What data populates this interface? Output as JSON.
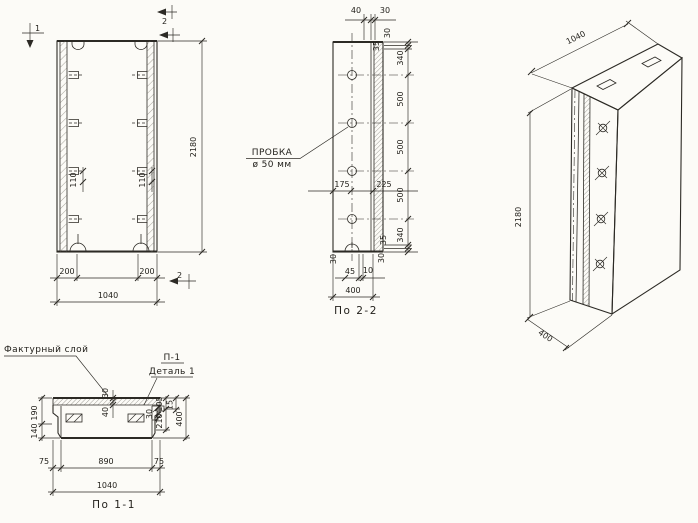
{
  "front_view": {
    "section_marks": {
      "top_1": "1",
      "top_2": "2",
      "bottom_2": "2"
    },
    "dims": {
      "height": "2180",
      "anchor_left": "110",
      "anchor_right": "110",
      "edge_left": "200",
      "edge_right": "200",
      "width": "1040"
    }
  },
  "section_2_2": {
    "title": "По 2-2",
    "plug_label": {
      "line1": "ПРОБКА",
      "line2": "ø 50 мм"
    },
    "dims": {
      "top_40": "40",
      "top_30": "30",
      "right_top_30": "30",
      "right_top_35": "35",
      "right_chain": [
        "340",
        "500",
        "500",
        "500",
        "340"
      ],
      "right_bottom_35": "35",
      "right_bottom_30": "30",
      "mid_175": "175",
      "mid_225": "225",
      "bottom_left_30": "30",
      "bottom_45": "45",
      "bottom_10": "10",
      "width": "400"
    }
  },
  "iso_view": {
    "dims": {
      "width": "1040",
      "height": "2180",
      "depth": "400"
    }
  },
  "section_1_1": {
    "title": "По 1-1",
    "labels": {
      "facing": "Фактурный слой",
      "p1": "П-1",
      "detail": "Деталь 1"
    },
    "dims": {
      "top_30": "30",
      "top_40": "40",
      "left_190": "190",
      "left_140": "140",
      "right_105": "105",
      "right_15": "15",
      "right_210": "210",
      "right_30": "30",
      "right_400": "400",
      "bottom_75_left": "75",
      "bottom_890": "890",
      "bottom_75_right": "75",
      "bottom_width": "1040"
    }
  }
}
